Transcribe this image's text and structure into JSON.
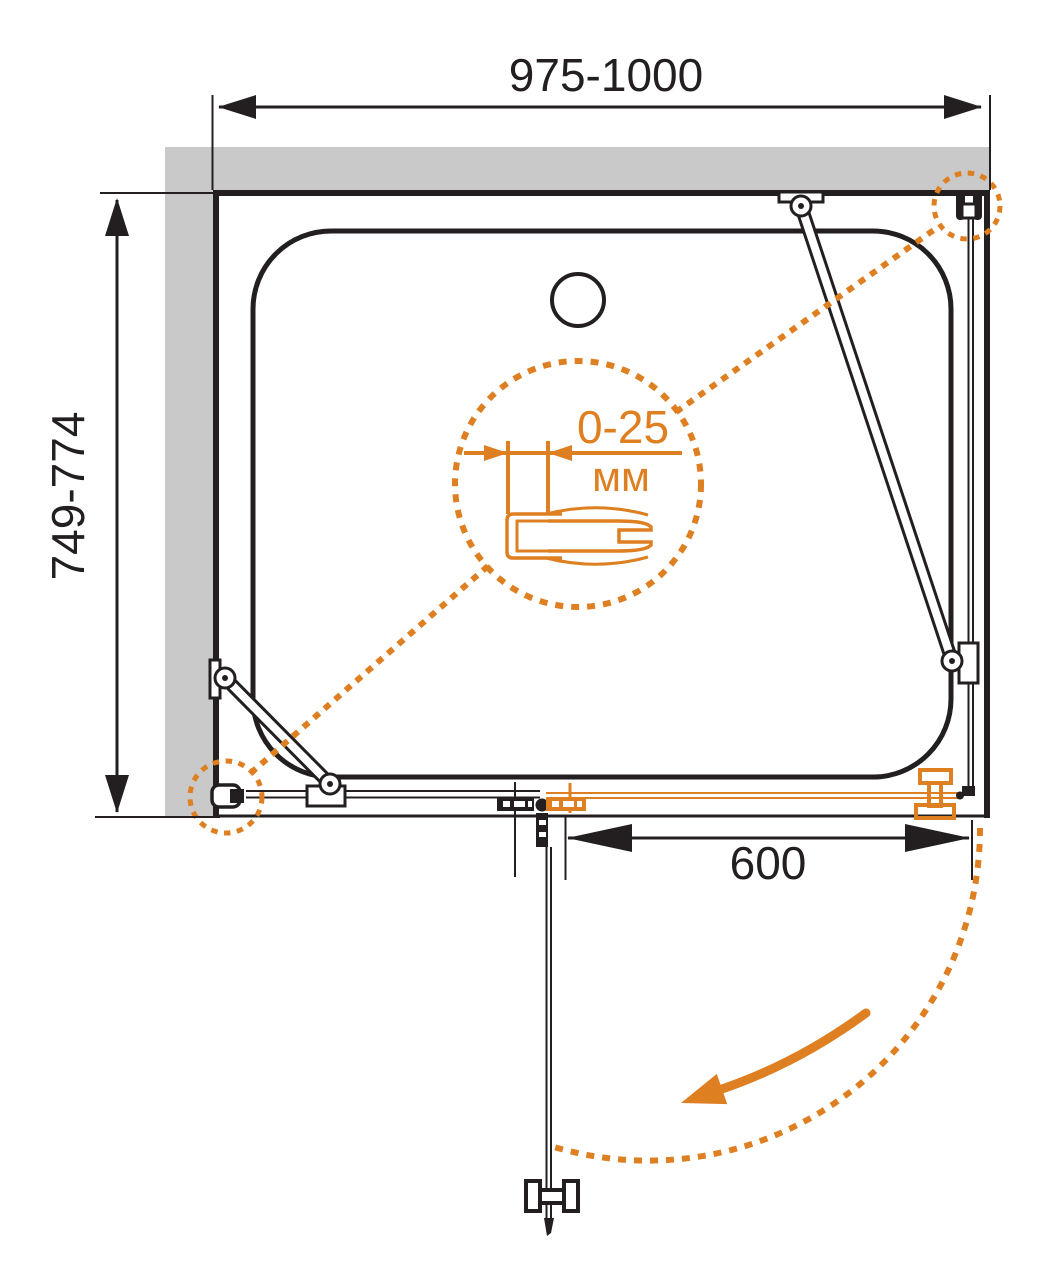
{
  "labels": {
    "width_range": "975-1000",
    "depth_range": "749-774",
    "door_width": "600",
    "adjustment_range": "0-25",
    "adjustment_unit": "мм"
  },
  "colors": {
    "accent": "#DE7F21",
    "ink": "#231F20",
    "wall": "#C9C9C9",
    "background": "#FFFFFF"
  }
}
